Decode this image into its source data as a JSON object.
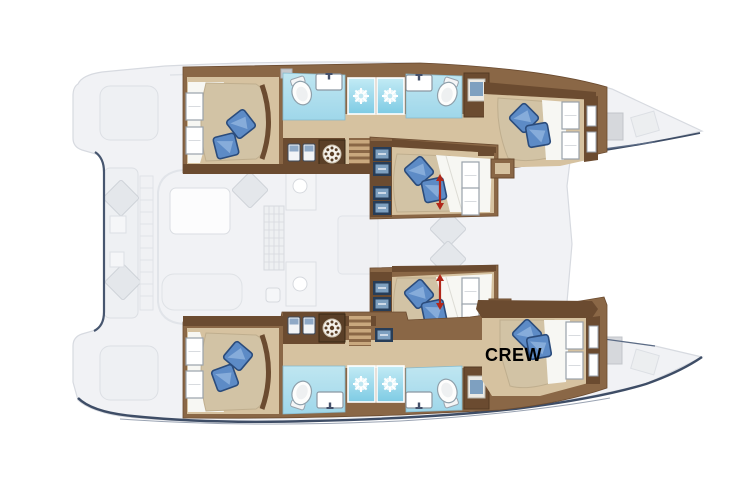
{
  "plan": {
    "labels": {
      "crew_cabin": "CREW"
    },
    "colors": {
      "hull_navy_outline": "#3e4d66",
      "exterior_fill": "#f1f2f5",
      "exterior_line": "#d7dae0",
      "wood_dark": "#6b4b30",
      "wood_mid": "#8a6746",
      "wood_step_light": "#c9a87e",
      "cabin_floor_tan": "#d6c2a0",
      "mattress_beige": "#d2c3a5",
      "duvet_white": "#f7f7f3",
      "pillow_blue": "#5d8bc6",
      "pillow_blue_dark": "#2b4c7c",
      "bath_floor_blue": "#aadded",
      "shower_blue": "#7ecbe4",
      "locker_front_blue": "#7ea0c0",
      "arrow_red": "#b1271a",
      "label_black": "#000000"
    },
    "icons": {
      "shower": "spray-starburst-icon",
      "washing_machine": "washer-drum-icon",
      "toilet": "toilet-bowl-icon",
      "sink": "sink-basin-icon",
      "fridge": "fridge-locker-icon",
      "stairs": "companionway-stairs-icon",
      "wardrobe": "blue-locker-icon",
      "bed_slide": "red-double-arrow-icon",
      "pillow": "blue-pillow-icon",
      "cushion": "gray-cushion-icon"
    }
  }
}
